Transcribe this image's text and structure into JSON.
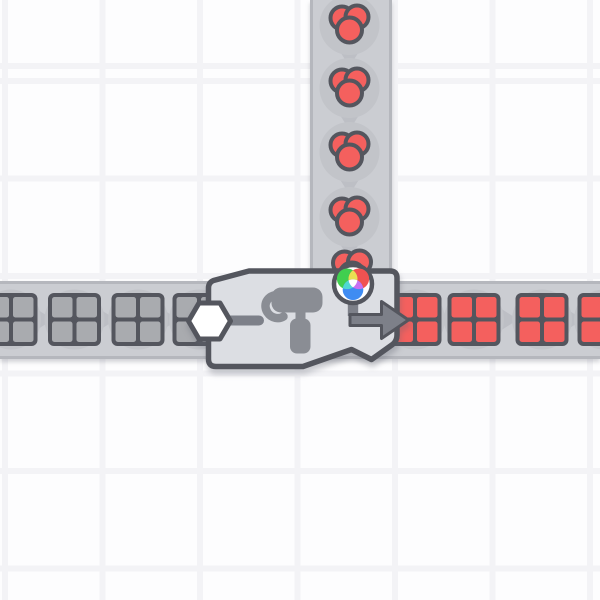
{
  "scene": {
    "label": "Factory game canvas: painter machine painting square shapes red",
    "grid": {
      "tile_size_px": 97.5,
      "gutter_px": 6
    },
    "machine": {
      "label": "Painter machine",
      "type": "painter",
      "shape_input_label": "Shape input port (white hexagon)",
      "color_input_label": "Color input (RGB color wheel indicator)",
      "output_label": "Output arrow pointing right",
      "icon": "paint-roller-icon"
    },
    "belts": {
      "horizontal": {
        "label": "Horizontal conveyor belt",
        "direction": "right"
      },
      "vertical": {
        "label": "Vertical conveyor belt",
        "direction": "down"
      }
    },
    "items": {
      "uncolored_squares": {
        "label": "Uncolored square shape (2x2 windowpane)",
        "count": 4,
        "state": "entering from left"
      },
      "red_color_blobs": {
        "label": "Red color item (cluster of 3 paint blobs)",
        "count": 5,
        "state": "feeding down into painter"
      },
      "red_squares": {
        "label": "Red painted square shape (2x2 windowpane)",
        "count": 4,
        "state": "exiting to right"
      }
    }
  },
  "colors": {
    "bg_cell": "#fdfdfe",
    "bg_gutter": "#f3f3f6",
    "belt": "#cbcdd2",
    "belt_edge": "#b5b7bd",
    "belt_chevron": "#bdbfc5",
    "puck": "#c2c4c9",
    "outline": "#54565e",
    "machine_body": "#dcdee3",
    "icon_gray": "#7d8089",
    "roller_gray": "#8a8d94",
    "item_gray": "#a9abaf",
    "item_red": "#f4605e",
    "port_white": "#ffffff",
    "wheel_green": "#41cf4f",
    "wheel_red": "#f05251",
    "wheel_blue": "#3f8cf2",
    "wheel_yellow": "#e9e052",
    "wheel_cyan": "#4fd8d2",
    "wheel_magenta": "#c770f2"
  }
}
